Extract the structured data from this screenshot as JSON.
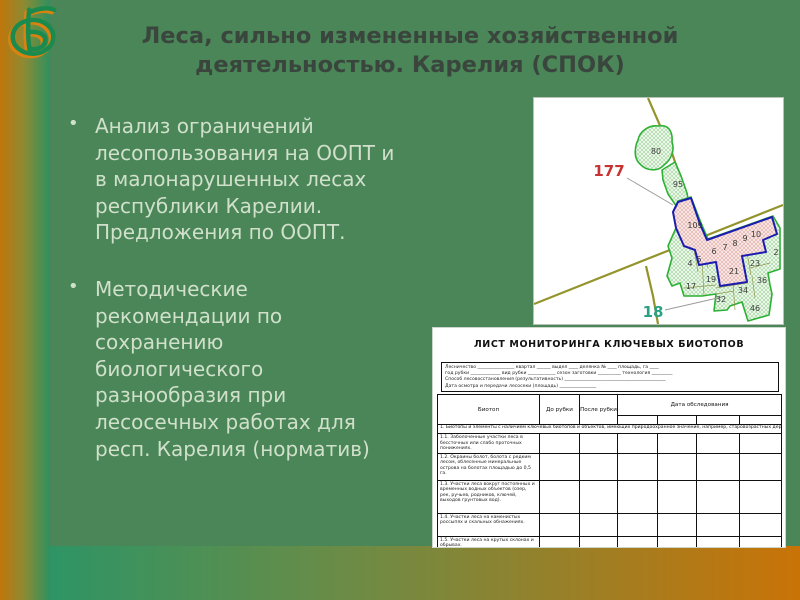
{
  "palette": {
    "bg": "#4a8657",
    "title": "#3a463d",
    "bullet_text": "#d0e0cb",
    "strip_orange": "#c0760b",
    "strip_olive": "#8d8a33",
    "strip_green": "#2e9160",
    "bottom_teal": "#2e9465",
    "bottom_orange": "#c97307",
    "map_road": "#8e8e21",
    "plot_green": "#2cb135",
    "selected_blue": "#1c1cb0",
    "ref_red": "#c83232",
    "ref_teal": "#2aa183"
  },
  "slide": {
    "title": "Леса, сильно измененные хозяйственной деятельностью. Карелия (СПОК)",
    "bullet_marker": "•",
    "bullets": [
      {
        "text": "Анализ ограничений лесопользования на ООПТ и в малонарушенных лесах республики Карелии. Предложения по ООПТ."
      },
      {
        "text": "Методические рекомендации по  сохранению биологического разнообразия при лесосечных работах для респ. Карелия (норматив)"
      }
    ]
  },
  "map": {
    "labels": [
      {
        "n": "177",
        "x": 75,
        "y": 78,
        "cls": "ref-red"
      },
      {
        "n": "18",
        "x": 119,
        "y": 219,
        "cls": "ref-teal"
      },
      {
        "n": "80",
        "x": 122,
        "y": 56,
        "cls": "plot"
      },
      {
        "n": "95",
        "x": 144,
        "y": 89,
        "cls": "plot"
      },
      {
        "n": "109",
        "x": 161,
        "y": 130,
        "cls": "plot"
      },
      {
        "n": "4",
        "x": 156,
        "y": 168,
        "cls": "plot"
      },
      {
        "n": "5",
        "x": 165,
        "y": 164,
        "cls": "plot"
      },
      {
        "n": "6",
        "x": 180,
        "y": 156,
        "cls": "plot"
      },
      {
        "n": "7",
        "x": 191,
        "y": 152,
        "cls": "plot"
      },
      {
        "n": "8",
        "x": 201,
        "y": 148,
        "cls": "plot"
      },
      {
        "n": "9",
        "x": 211,
        "y": 143,
        "cls": "plot"
      },
      {
        "n": "10",
        "x": 222,
        "y": 139,
        "cls": "plot"
      },
      {
        "n": "17",
        "x": 157,
        "y": 191,
        "cls": "plot"
      },
      {
        "n": "19",
        "x": 177,
        "y": 184,
        "cls": "plot"
      },
      {
        "n": "21",
        "x": 200,
        "y": 176,
        "cls": "plot"
      },
      {
        "n": "23",
        "x": 221,
        "y": 168,
        "cls": "plot"
      },
      {
        "n": "2",
        "x": 242,
        "y": 157,
        "cls": "plot"
      },
      {
        "n": "32",
        "x": 187,
        "y": 204,
        "cls": "plot"
      },
      {
        "n": "34",
        "x": 209,
        "y": 195,
        "cls": "plot"
      },
      {
        "n": "36",
        "x": 228,
        "y": 185,
        "cls": "plot"
      },
      {
        "n": "46",
        "x": 221,
        "y": 213,
        "cls": "plot"
      }
    ]
  },
  "monitoring_form": {
    "title": "ЛИСТ МОНИТОРИНГА КЛЮЧЕВЫХ БИОТОПОВ",
    "form_lines": [
      "Лесничество ________________  квартал ______  выдел ____  делянка № ____  площадь, га ____",
      "год рубки _____________  вид рубки ____________  сезон заготовки __________  технология _________",
      "Способ лесовосстановления (результативность) ____________________________________________",
      "Дата осмотра и передачи лесосеки (площадь) ________________"
    ],
    "columns": [
      "Биотоп",
      "До рубки",
      "После рубки",
      "Дата обследования"
    ],
    "section_header": "1. Биотопы и элементы с наличием ключевых биотопов и объектов, имеющих природоохранное значение, например, старовозрастных деревьев и биотопов",
    "rows": [
      {
        "h": 19,
        "text": "1.1. Заболоченные участки леса в бессточных или слабо проточных понижениях."
      },
      {
        "h": 27,
        "text": "1.2. Окраины болот, болота с редким лесом, облесенные минеральные острова на болотах площадью до 0,5 га."
      },
      {
        "h": 33,
        "text": "1.3. Участки леса вокруг постоянных и временных водных объектов (озер, рек, ручьев, родников, ключей, выходов грунтовых вод)."
      },
      {
        "h": 23,
        "text": "1.4. Участки леса на каменистых россыпях и скальных обнажениях."
      },
      {
        "h": 14,
        "text": "1.5. Участки леса на крутых склонах и обрывах."
      }
    ]
  }
}
